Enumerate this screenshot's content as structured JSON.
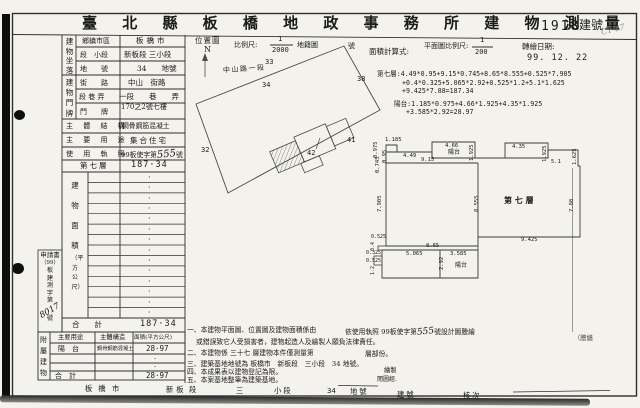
{
  "doc": {
    "title": "臺 北 縣 板 橋 地 政 事 務 所 建 物 測 量 成 果 圖",
    "building_no": "1918",
    "building_no_label": "建號",
    "corner_mark": "C1-07",
    "area_formula_label": "面積計算式:",
    "plan_scale_label": "平面圖比例尺:",
    "plan_scale_num": "1",
    "plan_scale_den": "200",
    "transcribe_date_label": "轉繪日期:",
    "transcribe_date": "99. 12. 22"
  },
  "location": {
    "group_location": "建物坐落",
    "group_door": "建物門牌",
    "district_label": "鄉鎮市區",
    "district": "板橋市",
    "section_label": "段　小段",
    "section": "新板段 三小段",
    "lot_label": "地　　號",
    "lot": "34　　地號",
    "street_label": "街　　路",
    "street": "中山　街路",
    "lane_label": "段 巷 弄",
    "lane": "一段　　巷　　弄",
    "door_label": "門　　牌",
    "door": "170之2號七樓",
    "structure_label": "主 體 結 構",
    "structure": "鋼骨鋼筋混凝土",
    "use_label": "主 要 用 途",
    "use": "集合住宅",
    "license_label": "使 用 執 照",
    "license_prefix": "99板使字第",
    "license_no": "555",
    "license_suffix": "號"
  },
  "area_table": {
    "floor_label": "第七層",
    "floor_area": "187·34",
    "side_label_main": "建物面積",
    "side_label_unit": "（平方公尺）",
    "dot": "·",
    "total_label": "合　　計",
    "total": "187·34"
  },
  "application": {
    "line1": "申請書",
    "line2": "（99）",
    "line3": "板建測字第",
    "hand_no": "8017",
    "line4": "號"
  },
  "annex": {
    "side_label": "附屬建物",
    "col_use": "主要用途",
    "col_structure": "主體構造",
    "col_area": "面積(平方公尺)",
    "row_use": "陽　台",
    "row_structure": "鋼骨鋼筋混凝土",
    "row_area": "28·97",
    "dot": "·",
    "total_label": "合　計",
    "total": "28·97"
  },
  "map": {
    "label": "位置圖",
    "scale_label": "比例尺:",
    "scale_num": "1",
    "scale_den": "2000",
    "cadastral_label": "地籍圖",
    "cadastral_suffix": "號",
    "north": "N",
    "road": "中山路一段",
    "p33": "33",
    "p34": "34",
    "p38": "38",
    "p32": "32",
    "p41": "41",
    "p42": "42"
  },
  "plan": {
    "room": "第 七 層",
    "balcony_top": "陽台",
    "balcony_bottom": "陽台",
    "dims": {
      "d1": "0.975",
      "d2": "1.185",
      "d3": "4.49",
      "d4": "0.95",
      "d5": "4.66",
      "d6": "1.925",
      "d7": "9.15",
      "d8": "0.745",
      "d9": "4.35",
      "d10": "1.925",
      "d11": "5.1",
      "d12": "1.625",
      "d13": "7.905",
      "d14": "8.555",
      "d15": "7.88",
      "d16": "9.425",
      "d17": "8.65",
      "d18": "0.525",
      "d19": "0.4",
      "d20": "0.325",
      "d21": "0.525",
      "d22": "1.2",
      "d23": "5.065",
      "d24": "3.585",
      "d25": "2.92"
    }
  },
  "formulas": {
    "f1": "第七層:4.49*0.95+9.15*0.745+8.65*8.555+0.525*7.905",
    "f2": "+0.4*0.325+5.065*2.92+0.525*1.2+5.1*1.625",
    "f3": "+9.425*7.88=187.34",
    "f4": "陽台:1.185*0.975+4.66*1.925+4.35*1.925",
    "f5": "+3.585*2.92=28.97"
  },
  "notes": {
    "n1": "一、本建物平面圖、位置圖及建物面積係由",
    "n1b": "依使用執照 99板使字第",
    "n1_hand": "555",
    "n1c": "號設計圖謄繪",
    "n1d": "（謄繕",
    "n2": "或錯誤致它人受損害者，建物起造人及繪製人願負法律責任。",
    "n3": "二、本建物係 三十七 層建物本件僅測量第",
    "n3b": "層部份。",
    "n4": "三、建築基地地號為 板橋市　新板段　三小段　34 地號。",
    "n5": "四、本成果表以建物登記為限。",
    "n6": "五、本案基地整筆為建築基地。",
    "sig1": "繪製",
    "sig2": "閱圖經."
  },
  "footer": {
    "city": "板橋",
    "city_suffix": "市",
    "section": "新板",
    "section_suffix": "段",
    "subsection": "三",
    "subsection_suffix": "小段",
    "lot": "34",
    "lot_suffix": "地號",
    "bno_suffix": "建號",
    "check": "核次"
  }
}
